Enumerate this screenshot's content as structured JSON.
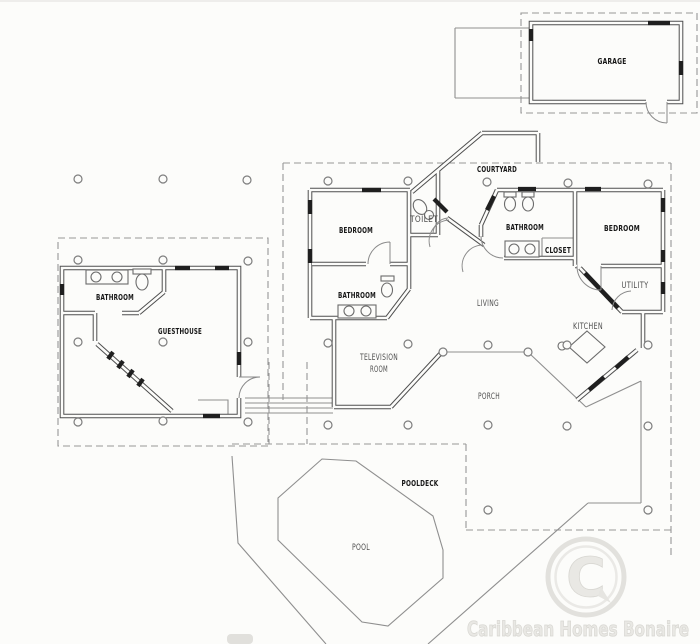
{
  "rooms": {
    "garage": "GARAGE",
    "courtyard": "COURTYARD",
    "toilet": "TOILET",
    "bedroom_left": "BEDROOM",
    "bathroom_main": "BATHROOM",
    "bathroom_master": "BATHROOM",
    "bedroom_master": "BEDROOM",
    "closet": "CLOSET",
    "utility": "UTILITY",
    "living": "LIVING",
    "kitchen": "KITCHEN",
    "television_room": {
      "line1": "TELEVISION",
      "line2": "ROOM"
    },
    "porch": "PORCH",
    "bathroom_guesthouse": "BATHROOM",
    "guesthouse": "GUESTHOUSE",
    "pooldeck": "POOLDECK",
    "pool": "POOL"
  },
  "watermark": {
    "logo_letter": "C",
    "text": "Caribbean Homes Bonaire"
  },
  "colors": {
    "paper": "#fcfcfa",
    "wall": "#4f4f4f",
    "dark_fitting": "#1f1f1f",
    "thin_line": "#8f8f8f",
    "watermark_gray": "#e7e6e2"
  }
}
